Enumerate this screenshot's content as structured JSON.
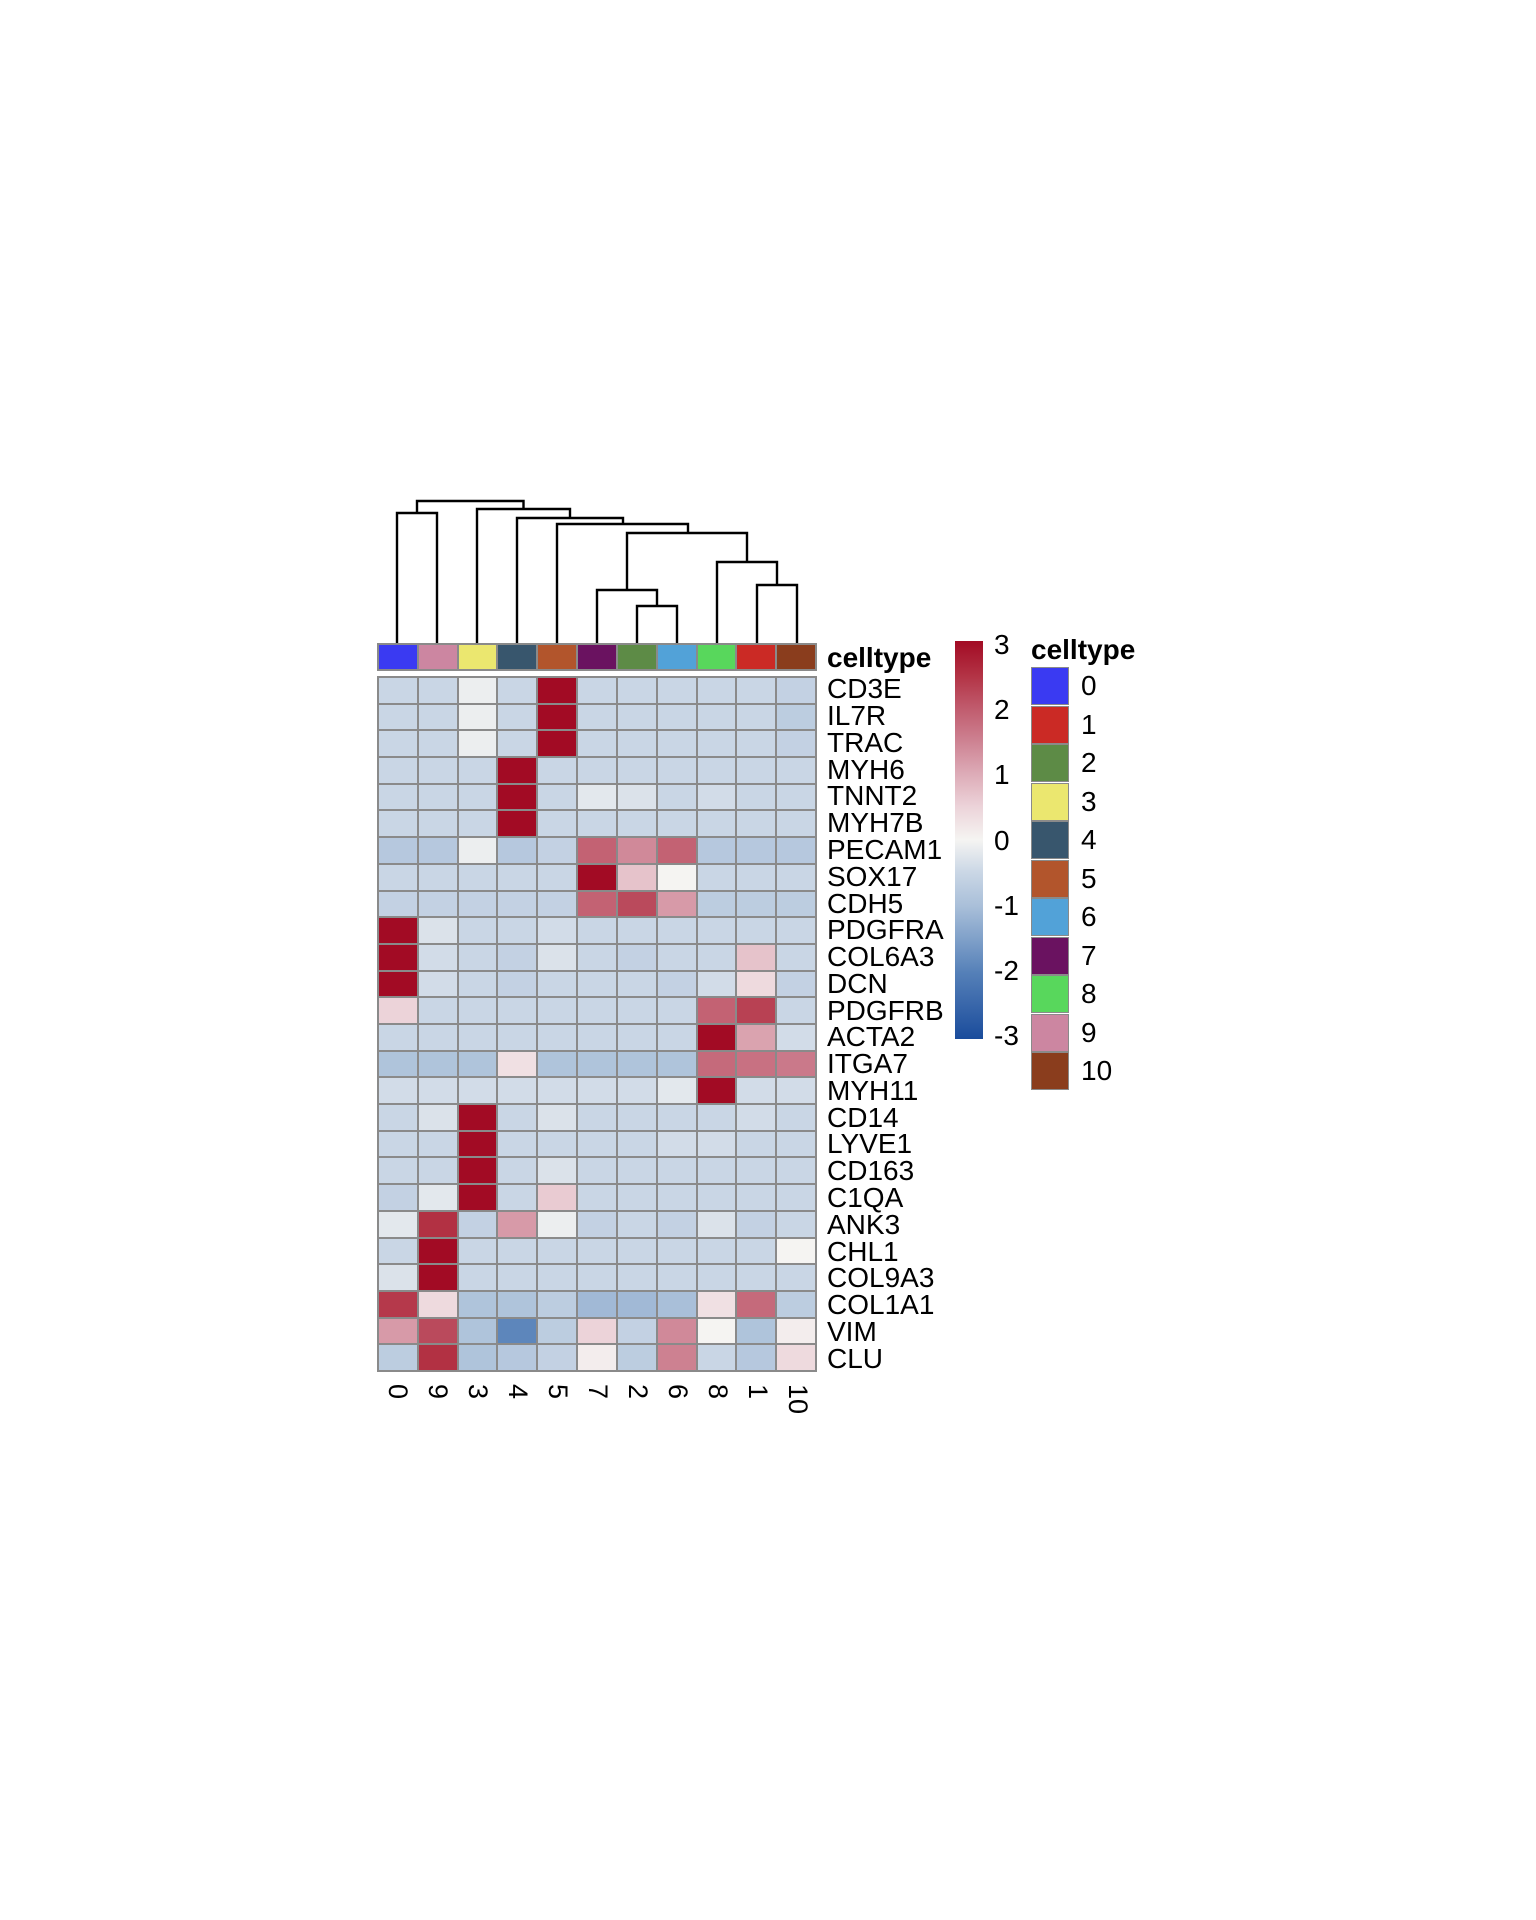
{
  "chart_data": {
    "type": "heatmap",
    "title": "",
    "columns": [
      "0",
      "9",
      "3",
      "4",
      "5",
      "7",
      "2",
      "6",
      "8",
      "1",
      "10"
    ],
    "rows": [
      "CD3E",
      "IL7R",
      "TRAC",
      "MYH6",
      "TNNT2",
      "MYH7B",
      "PECAM1",
      "SOX17",
      "CDH5",
      "PDGFRA",
      "COL6A3",
      "DCN",
      "PDGFRB",
      "ACTA2",
      "ITGA7",
      "MYH11",
      "CD14",
      "LYVE1",
      "CD163",
      "C1QA",
      "ANK3",
      "CHL1",
      "COL9A3",
      "COL1A1",
      "VIM",
      "CLU"
    ],
    "values": [
      [
        -0.5,
        -0.5,
        -0.1,
        -0.5,
        3,
        -0.5,
        -0.5,
        -0.5,
        -0.5,
        -0.5,
        -0.6
      ],
      [
        -0.5,
        -0.5,
        -0.1,
        -0.5,
        3,
        -0.5,
        -0.5,
        -0.5,
        -0.5,
        -0.5,
        -0.7
      ],
      [
        -0.5,
        -0.5,
        -0.1,
        -0.5,
        3,
        -0.5,
        -0.5,
        -0.5,
        -0.5,
        -0.5,
        -0.6
      ],
      [
        -0.5,
        -0.5,
        -0.5,
        3,
        -0.5,
        -0.5,
        -0.5,
        -0.5,
        -0.5,
        -0.5,
        -0.5
      ],
      [
        -0.5,
        -0.5,
        -0.5,
        3,
        -0.5,
        -0.2,
        -0.3,
        -0.5,
        -0.4,
        -0.5,
        -0.5
      ],
      [
        -0.5,
        -0.5,
        -0.5,
        3,
        -0.5,
        -0.5,
        -0.5,
        -0.5,
        -0.5,
        -0.5,
        -0.5
      ],
      [
        -0.8,
        -0.8,
        -0.1,
        -0.8,
        -0.6,
        1.9,
        1.4,
        1.9,
        -0.8,
        -0.8,
        -0.8
      ],
      [
        -0.5,
        -0.5,
        -0.5,
        -0.5,
        -0.5,
        3,
        0.7,
        0,
        -0.5,
        -0.5,
        -0.5
      ],
      [
        -0.6,
        -0.6,
        -0.6,
        -0.6,
        -0.6,
        1.9,
        2.2,
        1.2,
        -0.7,
        -0.7,
        -0.7
      ],
      [
        3,
        -0.3,
        -0.5,
        -0.5,
        -0.4,
        -0.5,
        -0.5,
        -0.5,
        -0.5,
        -0.5,
        -0.5
      ],
      [
        3,
        -0.4,
        -0.5,
        -0.6,
        -0.3,
        -0.5,
        -0.6,
        -0.5,
        -0.5,
        0.7,
        -0.5
      ],
      [
        3,
        -0.4,
        -0.5,
        -0.6,
        -0.5,
        -0.5,
        -0.5,
        -0.6,
        -0.4,
        0.4,
        -0.6
      ],
      [
        0.5,
        -0.5,
        -0.5,
        -0.5,
        -0.5,
        -0.5,
        -0.5,
        -0.5,
        1.9,
        2.3,
        -0.5
      ],
      [
        -0.5,
        -0.5,
        -0.5,
        -0.5,
        -0.5,
        -0.5,
        -0.5,
        -0.5,
        3,
        1.1,
        -0.4
      ],
      [
        -0.9,
        -0.9,
        -0.9,
        0.3,
        -0.9,
        -0.9,
        -0.9,
        -0.9,
        1.8,
        1.7,
        1.6
      ],
      [
        -0.4,
        -0.4,
        -0.4,
        -0.4,
        -0.4,
        -0.4,
        -0.4,
        -0.2,
        3,
        -0.4,
        -0.4
      ],
      [
        -0.5,
        -0.3,
        3,
        -0.5,
        -0.3,
        -0.5,
        -0.5,
        -0.5,
        -0.5,
        -0.4,
        -0.5
      ],
      [
        -0.5,
        -0.5,
        3,
        -0.5,
        -0.5,
        -0.5,
        -0.5,
        -0.4,
        -0.4,
        -0.5,
        -0.5
      ],
      [
        -0.5,
        -0.5,
        3,
        -0.5,
        -0.3,
        -0.5,
        -0.5,
        -0.5,
        -0.5,
        -0.5,
        -0.5
      ],
      [
        -0.6,
        -0.2,
        3,
        -0.5,
        0.6,
        -0.5,
        -0.5,
        -0.5,
        -0.5,
        -0.5,
        -0.5
      ],
      [
        -0.2,
        2.5,
        -0.6,
        1.2,
        -0.1,
        -0.6,
        -0.5,
        -0.6,
        -0.3,
        -0.6,
        -0.5
      ],
      [
        -0.5,
        3,
        -0.5,
        -0.5,
        -0.5,
        -0.5,
        -0.5,
        -0.5,
        -0.5,
        -0.5,
        0
      ],
      [
        -0.3,
        3,
        -0.5,
        -0.5,
        -0.5,
        -0.5,
        -0.5,
        -0.5,
        -0.5,
        -0.5,
        -0.5
      ],
      [
        2.4,
        0.4,
        -0.9,
        -0.9,
        -0.7,
        -1.1,
        -1.1,
        -1,
        0.3,
        1.8,
        -0.7
      ],
      [
        1.2,
        2.2,
        -0.9,
        -1.9,
        -0.7,
        0.5,
        -0.6,
        1.4,
        0,
        -0.9,
        0.1
      ],
      [
        -0.7,
        2.5,
        -0.9,
        -0.8,
        -0.6,
        0.1,
        -0.7,
        1.5,
        -0.5,
        -0.8,
        0.4
      ]
    ],
    "zlim": [
      -3,
      3
    ],
    "colorbar_ticks": [
      "3",
      "2",
      "1",
      "0",
      "-1",
      "-2",
      "-3"
    ],
    "colormap_stops": [
      [
        -3,
        "#1a4c9c"
      ],
      [
        -2,
        "#5580b8"
      ],
      [
        -1,
        "#a9bfd9"
      ],
      [
        -0.5,
        "#c9d6e5"
      ],
      [
        0,
        "#f5f4f2"
      ],
      [
        0.5,
        "#ecd3d9"
      ],
      [
        1,
        "#ddabb7"
      ],
      [
        1.5,
        "#cd8191"
      ],
      [
        2,
        "#c05a6c"
      ],
      [
        2.5,
        "#b23143"
      ],
      [
        3,
        "#a20b24"
      ]
    ],
    "column_annotation": {
      "name": "celltype"
    },
    "legend": {
      "title": "celltype",
      "entries": [
        {
          "label": "0",
          "color": "#3a3af2"
        },
        {
          "label": "1",
          "color": "#cb2a25"
        },
        {
          "label": "2",
          "color": "#5d8b46"
        },
        {
          "label": "3",
          "color": "#ebe76f"
        },
        {
          "label": "4",
          "color": "#38566d"
        },
        {
          "label": "5",
          "color": "#b2552c"
        },
        {
          "label": "6",
          "color": "#52a2d8"
        },
        {
          "label": "7",
          "color": "#6a1260"
        },
        {
          "label": "8",
          "color": "#58d75c"
        },
        {
          "label": "9",
          "color": "#cc86a1"
        },
        {
          "label": "10",
          "color": "#8a3d1d"
        }
      ]
    },
    "dendrogram_nodes": [
      {
        "x1": 40,
        "x2": 146.5,
        "y": 6,
        "d1": 18,
        "d2": 14
      },
      {
        "x1": 20,
        "x2": 60,
        "y": 18,
        "d1": 148,
        "d2": 148
      },
      {
        "x1": 100,
        "x2": 193,
        "y": 14,
        "d1": 148,
        "d2": 23
      },
      {
        "x1": 140,
        "x2": 246,
        "y": 23,
        "d1": 148,
        "d2": 29
      },
      {
        "x1": 180,
        "x2": 311,
        "y": 29,
        "d1": 148,
        "d2": 38
      },
      {
        "x1": 250,
        "x2": 370,
        "y": 38,
        "d1": 95,
        "d2": 67
      },
      {
        "x1": 220,
        "x2": 280,
        "y": 95,
        "d1": 148,
        "d2": 111
      },
      {
        "x1": 260,
        "x2": 300,
        "y": 111,
        "d1": 148,
        "d2": 148
      },
      {
        "x1": 340,
        "x2": 400,
        "y": 67,
        "d1": 148,
        "d2": 90
      },
      {
        "x1": 380,
        "x2": 420,
        "y": 90,
        "d1": 148,
        "d2": 148
      }
    ]
  }
}
